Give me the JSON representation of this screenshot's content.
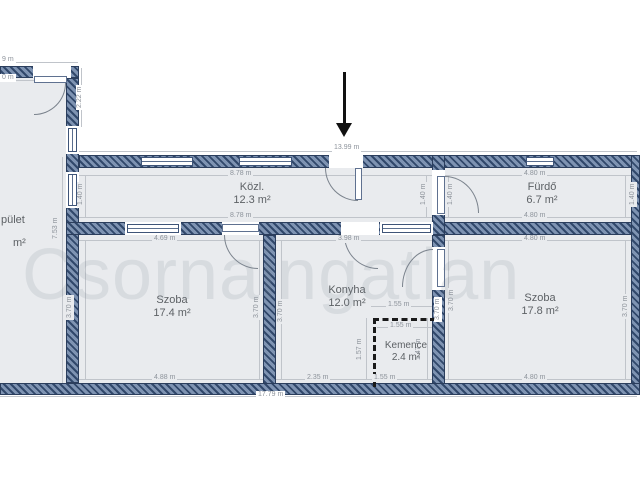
{
  "watermark": "Csornaingatlan",
  "rooms": {
    "left_building": {
      "name": "pület",
      "area": "m²"
    },
    "kozl": {
      "name": "Közl.",
      "area": "12.3 m²"
    },
    "furdo": {
      "name": "Fürdő",
      "area": "6.7 m²"
    },
    "szoba_left": {
      "name": "Szoba",
      "area": "17.4 m²"
    },
    "konyha": {
      "name": "Konyha",
      "area": "12.0 m²"
    },
    "kemence": {
      "name": "Kemence",
      "area": "2.4 m²"
    },
    "szoba_right": {
      "name": "Szoba",
      "area": "17.8 m²"
    }
  },
  "dimensions": {
    "top_overall": "13.99 m",
    "bottom_overall": "17.79 m",
    "left_cut_top": "9 m",
    "left_cut_bottom": "0 m",
    "left_door_height": "2.22 m",
    "left_wall_height": "7.53 m",
    "kozl_top": "8.78 m",
    "kozl_bottom": "8.78 m",
    "kozl_left": "1.40 m",
    "kozl_right": "1.40 m",
    "furdo_top": "4.80 m",
    "furdo_bottom": "4.80 m",
    "furdo_left": "1.40 m",
    "furdo_right": "1.40 m",
    "szoba_l_top": "4.69 m",
    "szoba_l_bottom": "4.88 m",
    "szoba_l_left": "3.70 m",
    "szoba_l_right": "3.70 m",
    "konyha_top": "3.98 m",
    "konyha_left": "3.70 m",
    "konyha_bottom_l": "2.35 m",
    "konyha_bottom_r": "1.55 m",
    "konyha_wall_right": "3.70 m",
    "kemence_top": "1.55 m",
    "kemence_inner": "1.55 m",
    "kemence_left": "1.57 m",
    "kemence_right": "1.47 m",
    "szoba_r_top": "4.80 m",
    "szoba_r_bottom": "4.80 m",
    "szoba_r_left": "3.70 m",
    "szoba_r_right": "3.70 m"
  },
  "colors": {
    "wall_dark": "#31486b",
    "wall_light": "#7e93b2",
    "room_fill": "#e9ebee",
    "dim_text": "#8d939b",
    "label_text": "#5d6165",
    "watermark": "#dfe2e6"
  }
}
